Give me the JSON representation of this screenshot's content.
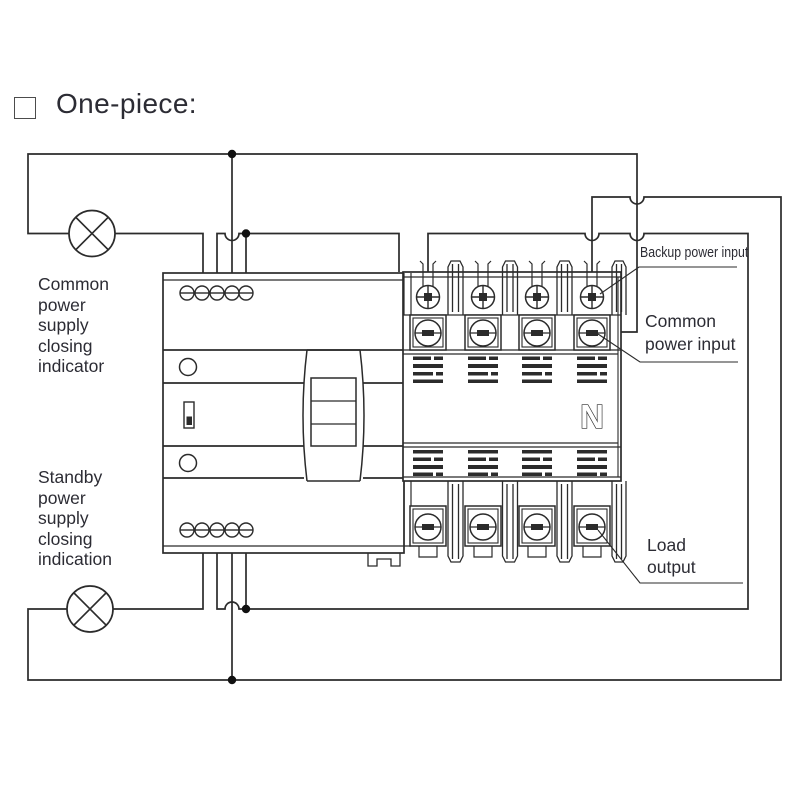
{
  "title": {
    "text": "One-piece:"
  },
  "labels": {
    "common_indicator": {
      "lines": [
        "Common",
        "power",
        "supply",
        "closing",
        "indicator"
      ]
    },
    "standby_indicator": {
      "lines": [
        "Standby",
        "power",
        "supply",
        "closing",
        "indication"
      ]
    },
    "backup_power_input": "Backup power input",
    "common_power_input": {
      "lines": [
        "Common",
        "power input"
      ]
    },
    "load_output": {
      "lines": [
        "Load",
        "output"
      ]
    },
    "neutral_marking": "N"
  },
  "device": {
    "type": "automatic transfer switch, one-piece",
    "poles": 4,
    "controller_terminals_top": 5,
    "controller_terminals_bottom": 5,
    "indicator_lamps": 2
  },
  "colors": {
    "line": "#2b2b2b",
    "text": "#2c2c34",
    "background": "#ffffff"
  }
}
